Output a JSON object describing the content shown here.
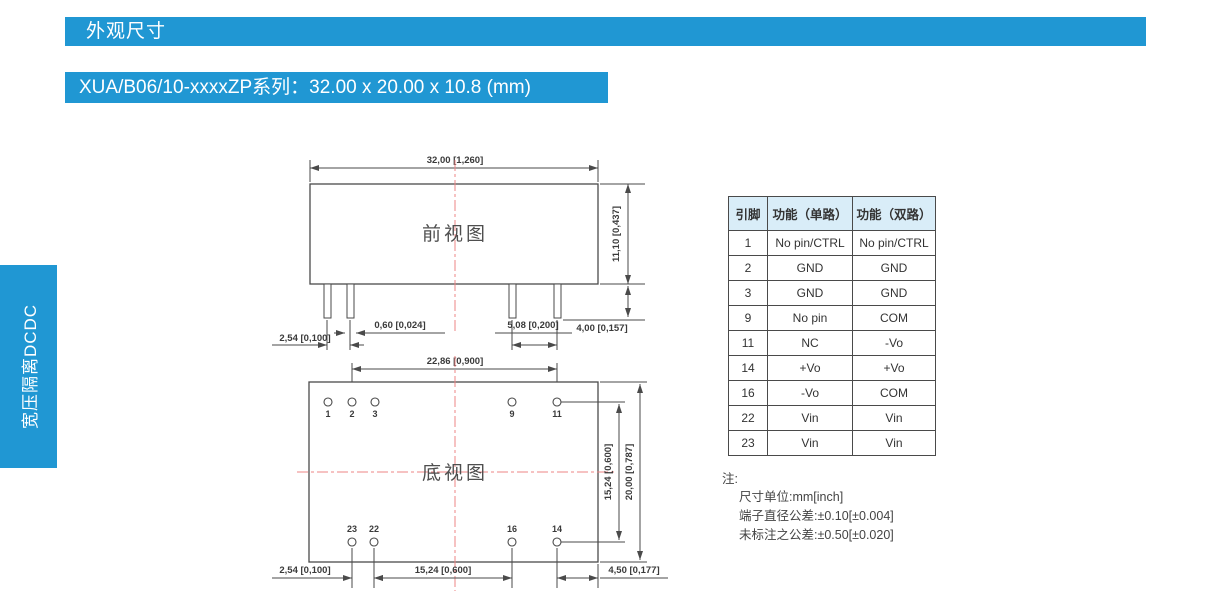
{
  "colors": {
    "accent": "#2097d3",
    "table_header_bg": "#d9edf8",
    "drawing_line": "#4a4a4a",
    "centerline_red": "#ee8585"
  },
  "header": {
    "title": "外观尺寸"
  },
  "subtitle": {
    "text": "XUA/B06/10-xxxxZP系列：32.00 x 20.00 x 10.8 (mm)"
  },
  "sidebar": {
    "label": "宽压隔离DCDC"
  },
  "front_view": {
    "label": "前视图",
    "dims": {
      "width": "32,00 [1,260]",
      "height": "11,10 [0,437]",
      "pin_pitch_left": "2,54 [0,100]",
      "pin_width": "0,60 [0,024]",
      "pin_pitch_right": "5,08 [0,200]",
      "pin_length": "4,00 [0,157]"
    }
  },
  "bottom_view": {
    "label": "底视图",
    "pins_top": [
      "1",
      "2",
      "3",
      "9",
      "11"
    ],
    "pins_bottom": [
      "23",
      "22",
      "16",
      "14"
    ],
    "dims": {
      "pin_span": "22,86 [0,900]",
      "row_span": "15,24 [0,600]",
      "height": "20,00 [0,787]",
      "pitch_left": "2,54 [0,100]",
      "span_bottom": "15,24 [0,600]",
      "edge_right": "4,50 [0,177]"
    }
  },
  "pin_table": {
    "headers": [
      "引脚",
      "功能（单路）",
      "功能（双路）"
    ],
    "rows": [
      [
        "1",
        "No pin/CTRL",
        "No pin/CTRL"
      ],
      [
        "2",
        "GND",
        "GND"
      ],
      [
        "3",
        "GND",
        "GND"
      ],
      [
        "9",
        "No pin",
        "COM"
      ],
      [
        "11",
        "NC",
        "-Vo"
      ],
      [
        "14",
        "+Vo",
        "+Vo"
      ],
      [
        "16",
        "-Vo",
        "COM"
      ],
      [
        "22",
        "Vin",
        "Vin"
      ],
      [
        "23",
        "Vin",
        "Vin"
      ]
    ]
  },
  "notes": {
    "title": "注:",
    "lines": [
      "尺寸单位:mm[inch]",
      "端子直径公差:±0.10[±0.004]",
      "未标注之公差:±0.50[±0.020]"
    ]
  }
}
